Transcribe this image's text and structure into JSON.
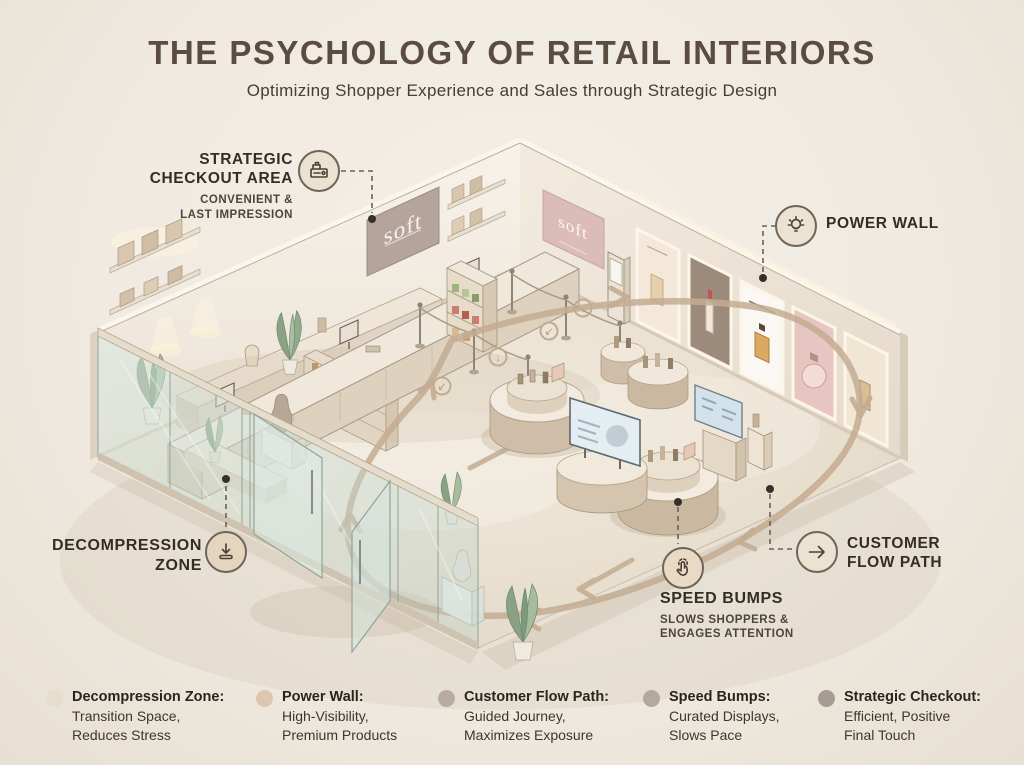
{
  "page": {
    "title": "THE PSYCHOLOGY OF RETAIL INTERIORS",
    "subtitle": "Optimizing Shopper Experience and Sales through Strategic Design"
  },
  "store": {
    "brand": "soft"
  },
  "callouts": {
    "strategic_checkout": {
      "icon": "cash-register-icon",
      "title_lines": [
        "STRATEGIC",
        "CHECKOUT AREA"
      ],
      "sub_lines": [
        "CONVENIENT &",
        "LAST IMPRESSION"
      ]
    },
    "power_wall": {
      "icon": "lightbulb-icon",
      "title": "POWER WALL"
    },
    "decompression_zone": {
      "icon": "entry-arrow-icon",
      "title_lines": [
        "DECOMPRESSION",
        "ZONE"
      ]
    },
    "customer_flow_path": {
      "icon": "arrow-right-icon",
      "title_lines": [
        "CUSTOMER",
        "FLOW PATH"
      ]
    },
    "speed_bumps": {
      "icon": "tap-hand-icon",
      "title": "SPEED BUMPS",
      "sub_lines": [
        "SLOWS SHOPPERS &",
        "ENGAGES ATTENTION"
      ]
    }
  },
  "legend": {
    "items": [
      {
        "label": "Decompression Zone:",
        "desc_lines": [
          "Transition Space,",
          "Reduces Stress"
        ],
        "dot_color": "#e8dcca"
      },
      {
        "label": "Power Wall:",
        "desc_lines": [
          "High-Visibility,",
          "Premium Products"
        ],
        "dot_color": "#dcc6ae"
      },
      {
        "label": "Customer Flow Path:",
        "desc_lines": [
          "Guided Journey,",
          "Maximizes Exposure"
        ],
        "dot_color": "#b9aba4"
      },
      {
        "label": "Speed Bumps:",
        "desc_lines": [
          "Curated Displays,",
          "Slows Pace"
        ],
        "dot_color": "#b5a8a1"
      },
      {
        "label": "Strategic Checkout:",
        "desc_lines": [
          "Efficient, Positive",
          "Final Touch"
        ],
        "dot_color": "#a89b93"
      }
    ]
  },
  "colors": {
    "background": "#f0ebe3",
    "flow_path": "#c3ac92",
    "title_text": "#5a4c40",
    "connector": "#6b6156"
  }
}
